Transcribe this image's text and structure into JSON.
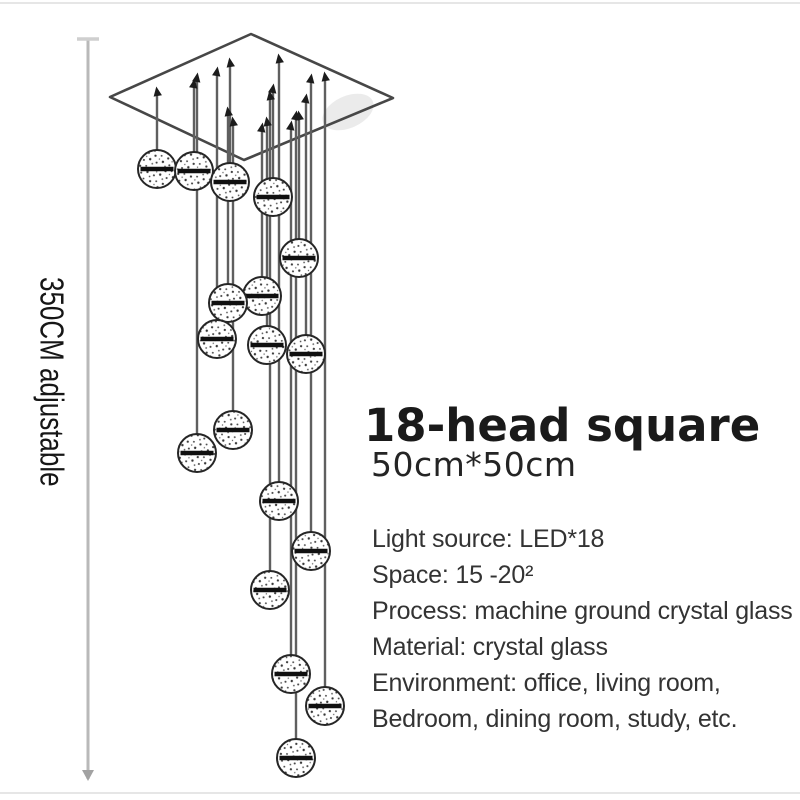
{
  "measure": {
    "label": "350CM adjustable"
  },
  "product": {
    "title": "18-head square",
    "size": "50cm*50cm",
    "specs": [
      "Light source: LED*18",
      "Space: 15 -20²",
      "Process: machine ground crystal glass",
      "Material: crystal glass",
      "Environment: office, living room,",
      "Bedroom, dining room, study, etc."
    ]
  },
  "colors": {
    "background": "#ffffff",
    "title": "#1a1a1a",
    "size": "#242424",
    "specs": "#333333",
    "measure_text": "#161616"
  },
  "figure": {
    "canopy_points": "251,34 393,98 244,160 110,97",
    "sphere_radius": 19,
    "colors": {
      "wire": "#5f5f5f",
      "pin": "#1c1c1c",
      "canopy_stroke": "#474747",
      "canopy_shade": "#ebebeb",
      "sphere_stroke": "#262626",
      "sphere_band": "#101010",
      "speckle": "#3c3c3c"
    },
    "measure_line": {
      "x": 88,
      "y1": 39,
      "y2": 779,
      "color": "#b9b9b9",
      "cap_color": "#cfcfcf",
      "arrow_color": "#a2a2a2"
    },
    "pendants": [
      {
        "x": 157,
        "pin_y": 91,
        "cy": 169
      },
      {
        "x": 194,
        "pin_y": 83,
        "cy": 171
      },
      {
        "x": 230,
        "pin_y": 62,
        "cy": 182
      },
      {
        "x": 273,
        "pin_y": 88,
        "cy": 197
      },
      {
        "x": 299,
        "pin_y": 115,
        "cy": 258
      },
      {
        "x": 262,
        "pin_y": 127,
        "cy": 296
      },
      {
        "x": 228,
        "pin_y": 111,
        "cy": 303
      },
      {
        "x": 217,
        "pin_y": 71,
        "cy": 339
      },
      {
        "x": 267,
        "pin_y": 121,
        "cy": 345
      },
      {
        "x": 306,
        "pin_y": 98,
        "cy": 354
      },
      {
        "x": 233,
        "pin_y": 121,
        "cy": 430
      },
      {
        "x": 197,
        "pin_y": 77,
        "cy": 453
      },
      {
        "x": 279,
        "pin_y": 58,
        "cy": 501
      },
      {
        "x": 311,
        "pin_y": 78,
        "cy": 551
      },
      {
        "x": 270,
        "pin_y": 95,
        "cy": 590
      },
      {
        "x": 291,
        "pin_y": 125,
        "cy": 674
      },
      {
        "x": 325,
        "pin_y": 76,
        "cy": 706
      },
      {
        "x": 296,
        "pin_y": 115,
        "cy": 758
      }
    ]
  }
}
